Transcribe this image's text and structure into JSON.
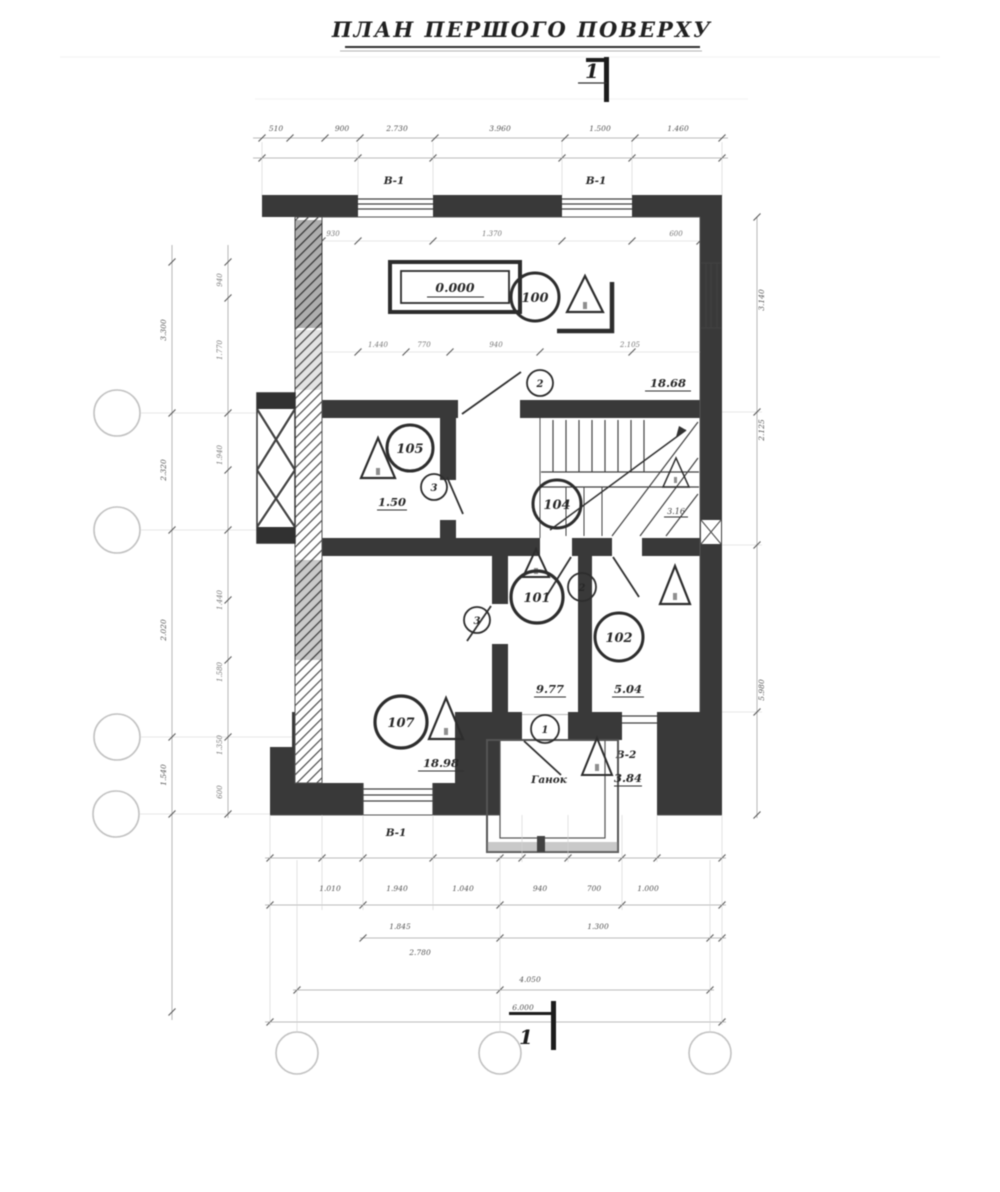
{
  "drawing": {
    "title": "ПЛАН ПЕРШОГО ПОВЕРХУ",
    "section_mark_top": "1",
    "section_mark_bottom": "1",
    "elevation": "0.000",
    "rooms": {
      "r100": {
        "number": "100",
        "area": "18.68"
      },
      "r105": {
        "number": "105",
        "area": "1.50"
      },
      "r104": {
        "number": "104"
      },
      "r101": {
        "number": "101",
        "area": "9.77"
      },
      "r102": {
        "number": "102",
        "area": "5.04"
      },
      "r107": {
        "number": "107",
        "area": "18.98"
      }
    },
    "porch": {
      "label": "Ганок",
      "area": "3.84"
    },
    "stair_mark": "3.16",
    "doors": {
      "top": "2",
      "room105": "3",
      "hall": "2",
      "room107": "3",
      "porch": "1"
    },
    "windows": {
      "top_left": "В-1",
      "top_mid": "В-1",
      "bottom": "В-1",
      "porch_side": "В-2"
    },
    "dims": {
      "top": [
        "510",
        "900",
        "2.730",
        "3.960",
        "1.500",
        "1.460"
      ],
      "top_inner": [
        "930",
        "1.370",
        "600"
      ],
      "room100_inner": [
        "1.440",
        "770",
        "940",
        "2.105"
      ],
      "bottom1": [
        "1.010",
        "1.940",
        "1.040",
        "940",
        "700",
        "1.000"
      ],
      "bottom2": [
        "1.845",
        "1.300"
      ],
      "bottom3": [
        "2.780"
      ],
      "bottom4": [
        "4.050"
      ],
      "bottom5": [
        "6.000"
      ],
      "left_outer": [
        "3.300",
        "2.320",
        "2.020",
        "1.540"
      ],
      "left_inner": [
        "940",
        "1.770",
        "1.940",
        "1.440",
        "1.580",
        "1.350",
        "600"
      ],
      "right": [
        "3.140",
        "2.125",
        "5.980"
      ]
    }
  },
  "colors": {
    "ink": "#2f2f2f",
    "wall": "#3b3b3b",
    "line": "#555555",
    "faint": "#a5a5a5",
    "paper": "#ffffff"
  }
}
